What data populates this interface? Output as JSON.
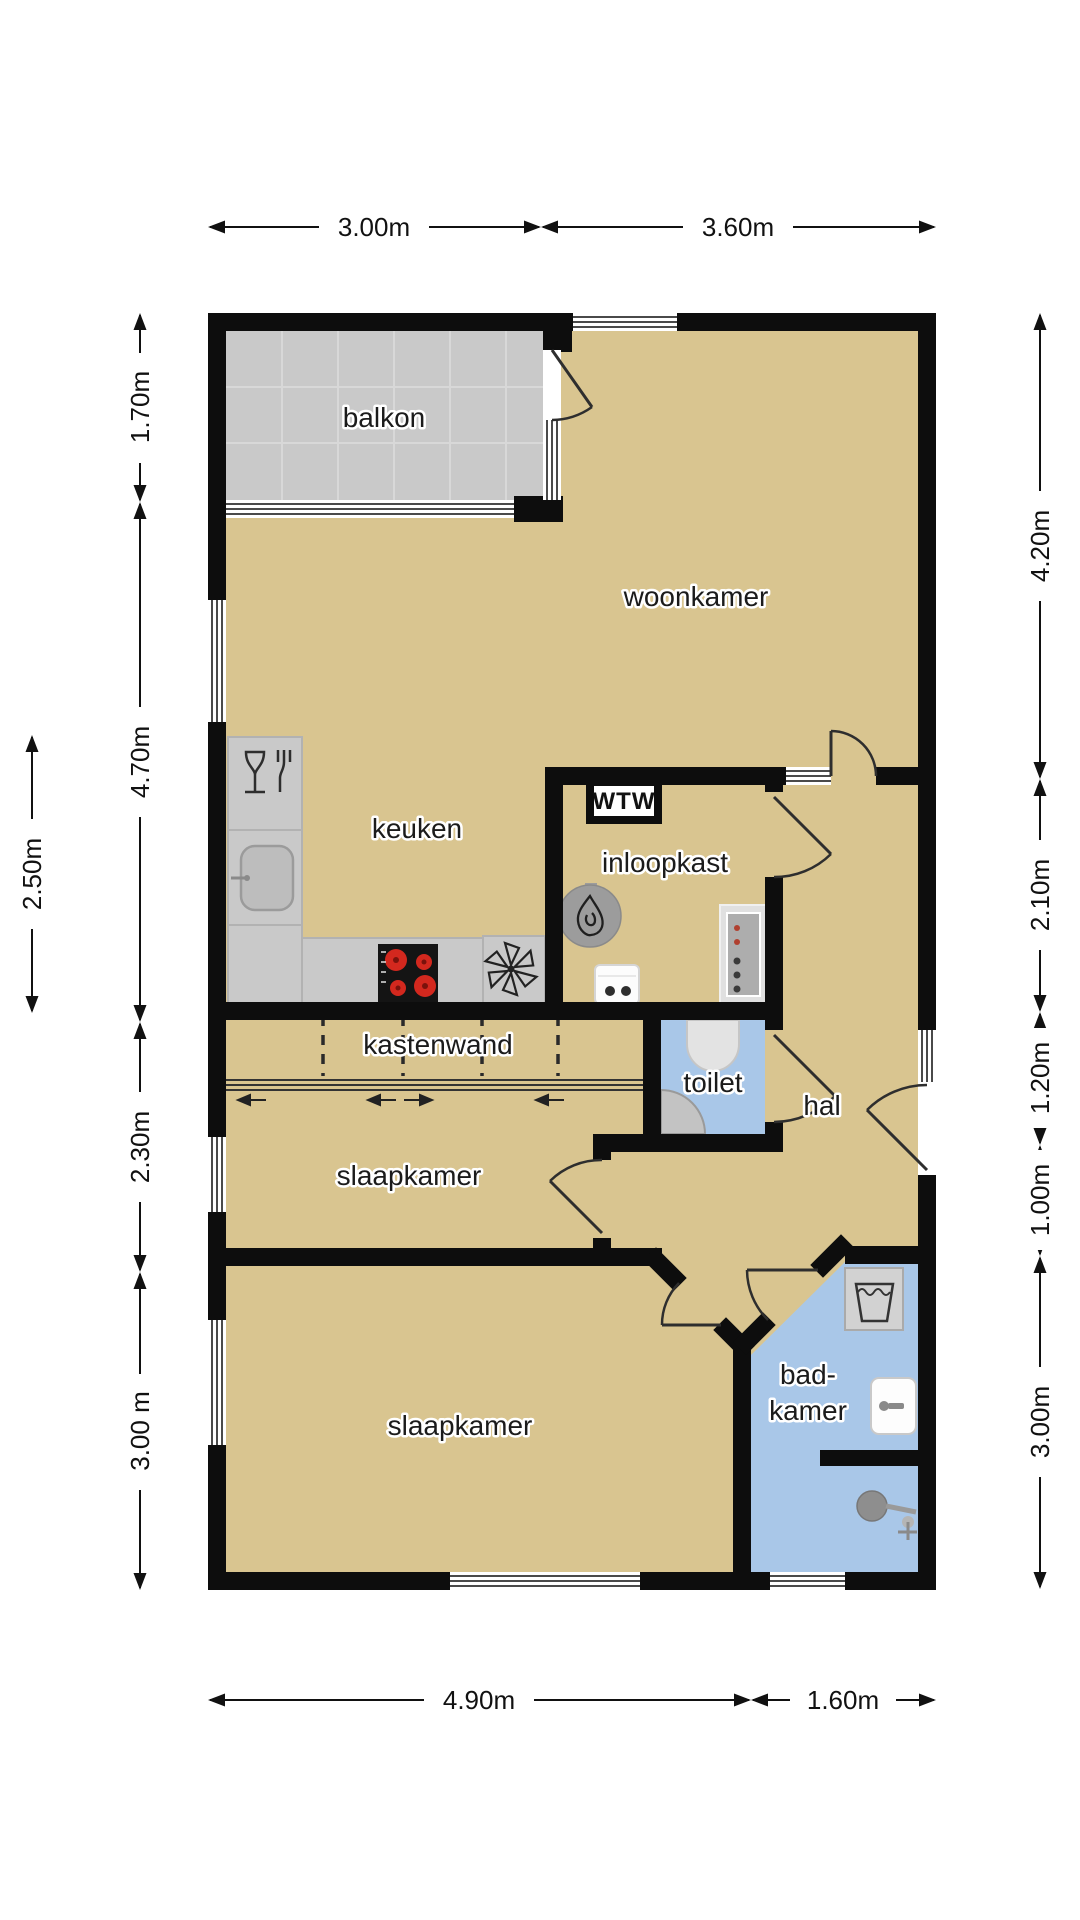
{
  "floorplan": {
    "rooms": {
      "balkon": "balkon",
      "woonkamer": "woonkamer",
      "keuken": "keuken",
      "inloopkast": "inloopkast",
      "wtw": "WTW",
      "kastenwand": "kastenwand",
      "toilet": "toilet",
      "hal": "hal",
      "slaapkamer_1": "slaapkamer",
      "slaapkamer_2": "slaapkamer",
      "badkamer_line_1": "bad-",
      "badkamer_line_2": "kamer"
    },
    "dimensions": {
      "top": [
        "3.00m",
        "3.60m"
      ],
      "bottom": [
        "4.90m",
        "1.60m"
      ],
      "left_outer": [
        "1.70m",
        "4.70m",
        "2.30m",
        "3.00 m"
      ],
      "left_inner": [
        "2.50m"
      ],
      "right": [
        "4.20m",
        "2.10m",
        "1.20m",
        "1.00m",
        "3.00m"
      ]
    },
    "colors": {
      "wall": "#0d0d0d",
      "floor_living": "#d9c590",
      "floor_wet": "#a9c7e8",
      "floor_balcony": "#c9c9c9",
      "counter": "#c9c9c9",
      "burner": "#d3281e"
    },
    "icons": [
      "dishwasher-icon",
      "kitchen-sink-icon",
      "cooktop-icon",
      "extractor-fan-icon",
      "boiler-icon",
      "power-outlet-icon",
      "electrical-panel-icon",
      "toilet-icon",
      "corner-sink-icon",
      "washing-machine-icon",
      "bathroom-sink-icon",
      "shower-icon"
    ]
  }
}
